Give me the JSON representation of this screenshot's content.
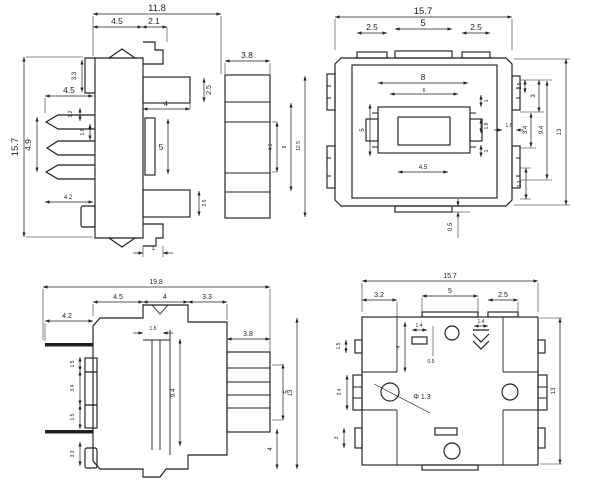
{
  "meta": {
    "type": "engineering-drawing",
    "background": "#ffffff",
    "ink": "#1f1f1f"
  },
  "views": {
    "front": {
      "label": "front-side-view",
      "dims": {
        "total_width": "11.8",
        "seg_a": "4.5",
        "seg_b": "2.1",
        "mate_width": "3.8",
        "total_height": "15.7",
        "step_height": "3.3",
        "pin_zone_width": "4.5",
        "pin_dim_a": "1.2",
        "pin_dim_b": "1.8",
        "pin_span": "4.9",
        "lead_length": "4.2",
        "slot_width": "4",
        "slot_height": "5",
        "block_top": "2.5",
        "block_bottom": "2.5",
        "mate_inner": "4.5",
        "mate_mid": "8",
        "mate_outer": "12.5",
        "tab_width": "1"
      }
    },
    "top": {
      "label": "top-view",
      "dims": {
        "total_width": "15.7",
        "tab_left": "2.5",
        "tab_center": "5",
        "tab_right": "2.5",
        "inner_w1": "8",
        "inner_w2": "6",
        "inner_h": "5",
        "inner_w3": "4.5",
        "stack_a": "1",
        "stack_b": "1.8",
        "stack_c": "1",
        "edge_w": "1.6",
        "right_a": "1.5",
        "right_b": "3",
        "right_c": "3.4",
        "right_d": "9.4",
        "right_e": "3.3",
        "total_height": "13",
        "tab_thickness": "0.5"
      }
    },
    "side": {
      "label": "side-section-view",
      "dims": {
        "total_width": "19.8",
        "seg_a": "4.5",
        "seg_b": "4",
        "seg_c": "3.3",
        "lead_length": "4.2",
        "left_a": "1.5",
        "left_b": "3.4",
        "left_c": "1.5",
        "left_d": "3.3",
        "post_w": "1.5",
        "core_h": "9.4",
        "mate_width": "3.8",
        "stack_h": "5",
        "total_height": "13",
        "bottom_h": "4"
      }
    },
    "bottom": {
      "label": "bottom-view",
      "dims": {
        "total_width": "15.7",
        "seg_a": "3.2",
        "seg_b": "5",
        "seg_c": "2.5",
        "left_a": "1.5",
        "left_b": "3.4",
        "left_c": "3",
        "corner_h": "4",
        "slot_a": "1.4",
        "slot_gap": "0.5",
        "mark_w": "1.4",
        "hole_dia": "Φ 1.3",
        "total_height": "13"
      }
    }
  }
}
